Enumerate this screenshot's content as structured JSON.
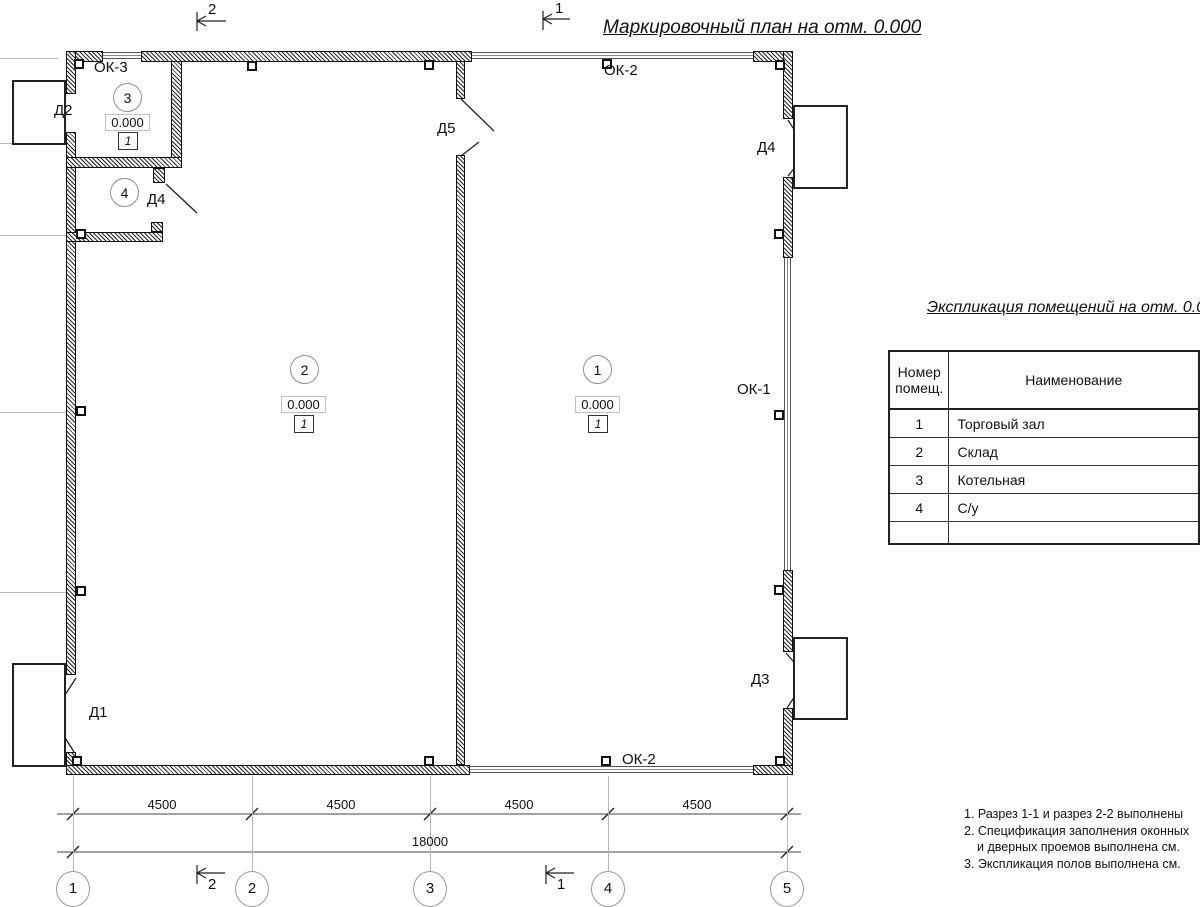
{
  "title": "Маркировочный план на отм. 0.000",
  "rooms": [
    {
      "number": "1",
      "elevation": "0.000",
      "floor": "1"
    },
    {
      "number": "2",
      "elevation": "0.000",
      "floor": "1"
    },
    {
      "number": "3",
      "elevation": "0.000",
      "floor": "1"
    },
    {
      "number": "4"
    }
  ],
  "doors": {
    "d1": "Д1",
    "d2": "Д2",
    "d3": "Д3",
    "d4a": "Д4",
    "d4b": "Д4",
    "d5": "Д5"
  },
  "windows": {
    "ok1": "ОК-1",
    "ok2_top": "ОК-2",
    "ok2_bottom": "ОК-2",
    "ok3": "ОК-3"
  },
  "sections": {
    "top_2": "2",
    "top_1": "1",
    "bottom_2": "2",
    "bottom_1": "1"
  },
  "dims": {
    "bays": [
      "4500",
      "4500",
      "4500",
      "4500"
    ],
    "total": "18000"
  },
  "grid": {
    "bubbles": [
      "1",
      "2",
      "3",
      "4",
      "5"
    ]
  },
  "table": {
    "title": "Экспликация помещений на отм. 0.000",
    "header": {
      "col1_line1": "Номер",
      "col1_line2": "помещ.",
      "col2": "Наименование"
    },
    "rows": [
      {
        "num": "1",
        "name": "Торговый зал"
      },
      {
        "num": "2",
        "name": "Склад"
      },
      {
        "num": "3",
        "name": "Котельная"
      },
      {
        "num": "4",
        "name": "С/у"
      }
    ]
  },
  "notes": [
    "1. Разрез 1-1 и разрез 2-2 выполнены",
    "2. Спецификация заполнения оконных",
    "и дверных проемов выполнена см.",
    "3. Экспликация полов выполнена см."
  ],
  "colors": {
    "line": "#111111",
    "grid_line": "#b8b8b8",
    "background": "#ffffff"
  }
}
